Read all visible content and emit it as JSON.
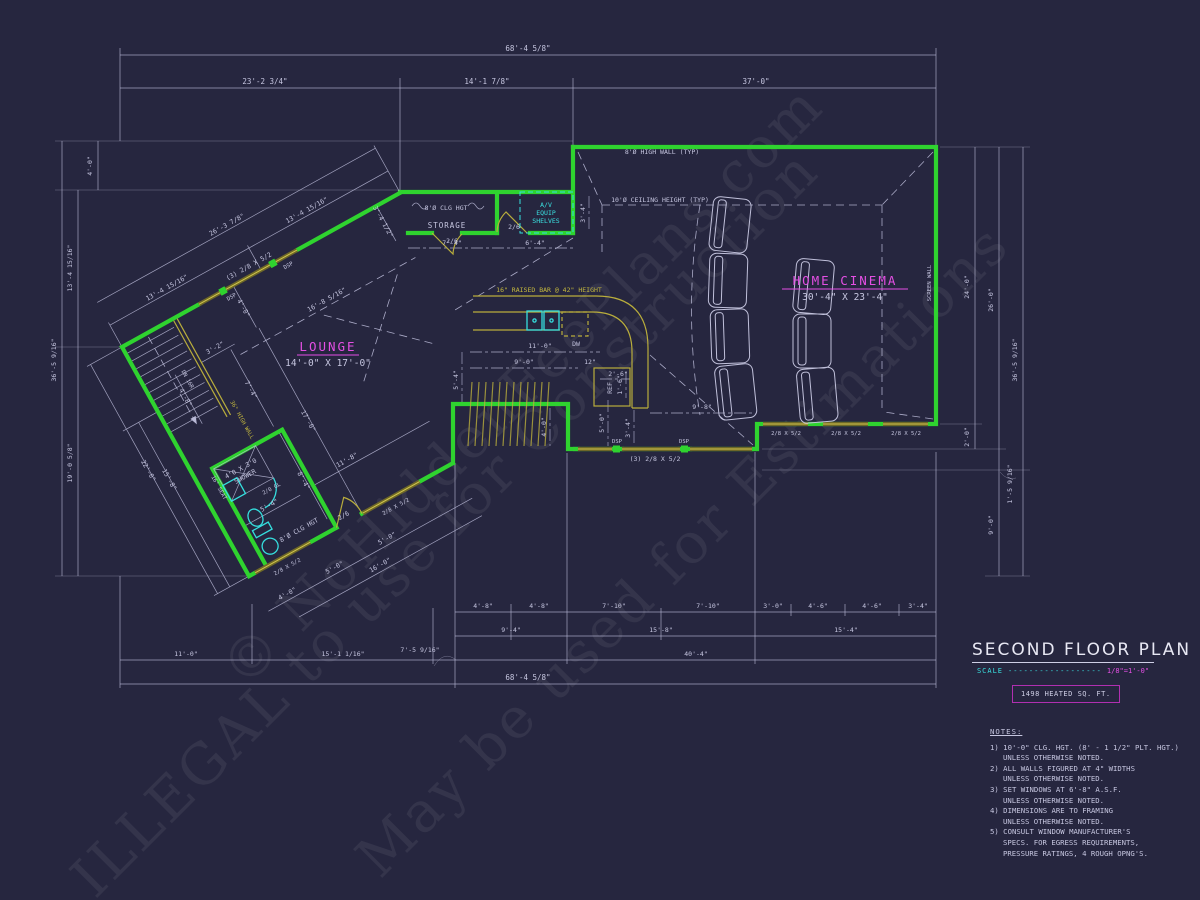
{
  "colors": {
    "bg": "#26263f",
    "wall_green": "#2fd32f",
    "dim_lavender": "#c6c6e0",
    "window_olive": "#b9ad3c",
    "fixture_cyan": "#35dede",
    "room_magenta": "#e44fe4",
    "title_white": "#e8e8f4"
  },
  "watermark": {
    "line1": "© NoHiddenFeePlans.com",
    "line2": "ILLEGAL to use for Construction",
    "line3": "May be used for Estimations"
  },
  "title_block": {
    "title": "SECOND FLOOR PLAN",
    "scale_label": "SCALE",
    "scale_dots": "------------------",
    "scale_value": "1/8\"=1'-0\"",
    "heated": "1498 HEATED SQ. FT."
  },
  "notes": {
    "heading": "NOTES:",
    "lines": [
      "1) 10'-0\"  CLG. HGT. (8' - 1 1/2\" PLT. HGT.)",
      "UNLESS OTHERWISE NOTED.",
      "2) ALL  WALLS FIGURED AT 4\" WIDTHS",
      "UNLESS OTHERWISE NOTED.",
      "3) SET WINDOWS AT 6'-8\" A.S.F.",
      "UNLESS OTHERWISE NOTED.",
      "4) DIMENSIONS ARE TO FRAMING",
      "UNLESS OTHERWISE NOTED.",
      "5) CONSULT WINDOW MANUFACTURER'S",
      "SPECS. FOR EGRESS REQUIREMENTS,",
      "PRESSURE RATINGS, 4 ROUGH OPNG'S."
    ]
  },
  "rooms": {
    "cinema": "HOME CINEMA",
    "cinema_size": "30'-4\" X 23'-4\"",
    "lounge": "LOUNGE",
    "lounge_size": "14'-0\" X 17'-0\"",
    "storage": "STORAGE"
  },
  "labels": {
    "high_wall": "8'Ø HIGH WALL (TYP)",
    "ceiling": "10'Ø CEILING HEIGHT (TYP)",
    "screen_wall": "SCREEN WALL",
    "clg_hgt": "8'Ø CLG HGT",
    "av1": "A/V",
    "av2": "EQUIP",
    "av3": "SHELVES",
    "raised_bar": "16\" RAISED BAR @ 42\" HEIGHT",
    "dw": "DW",
    "ref": "REF",
    "dsp": "DSP",
    "dn": "DN 16R",
    "half_wall": "36\" HIGH WALL",
    "shower1": "4'0 X 3'0",
    "shower2": "SHOWER",
    "seat": "16\" SEAT",
    "glass_door": "2/0 GL",
    "door_2_6": "2/6",
    "win_triple": "(3) 2/8 X 5/2",
    "win_single": "2/8 X 5/2"
  },
  "dims": {
    "top": [
      "68'-4 5/8\"",
      "23'-2 3/4\"",
      "14'-1 7/8\"",
      "37'-0\""
    ],
    "left": [
      "36'-5 9/16\"",
      "4'-0\"",
      "13'-4 15/16\"",
      "19'-0 5/8\""
    ],
    "right": [
      "24'-0\"",
      "2'-0\"",
      "26'-0\"",
      "9'-0\"",
      "1'-5 9/16\"",
      "36'-5 9/16\""
    ],
    "bottom_a": [
      "4'-8\"",
      "4'-8\"",
      "7'-10\"",
      "7'-10\"",
      "3'-0\"",
      "4'-6\"",
      "4'-6\"",
      "3'-4\""
    ],
    "bottom_b": [
      "9'-4\"",
      "15'-8\"",
      "15'-4\""
    ],
    "bottom_c": [
      "11'-0\"",
      "15'-1 1/16\"",
      "7'-5 9/16\"",
      "40'-4\""
    ],
    "bottom_d": [
      "68'-4 5/8\""
    ],
    "rot": [
      "13'-4 15/16\"",
      "13'-4 15/16\"",
      "26'-3 7/8\"",
      "16'-8 5/16\"",
      "11'-8\"",
      "22'-0\"",
      "15'-8\"",
      "3'-2\"",
      "4'-8\"",
      "7'-4\"",
      "17'-0\"",
      "8'-4\"",
      "5'-4\"",
      "3'-4 1/2\"",
      "4'-0\"",
      "4'-0\"",
      "5'-0\"",
      "5'-0\"",
      "16'-0\""
    ],
    "interior": [
      "7'-4\"",
      "6'-4\"",
      "3'-4\"",
      "11'-0\"",
      "9'-0\"",
      "12\"",
      "2'-6\"",
      "1'-6\"",
      "5'-4\"",
      "4'-0\"",
      "5'-0\"",
      "3'-4\"",
      "9'-8\""
    ]
  }
}
